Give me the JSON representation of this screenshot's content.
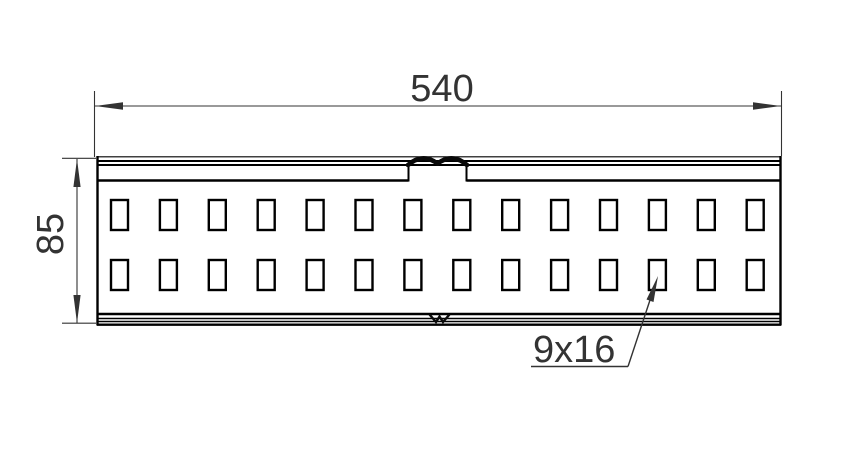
{
  "drawing": {
    "background": "#ffffff",
    "part_line_color": "#000000",
    "dimension_color": "#333333",
    "labels": {
      "length": "540",
      "height": "85",
      "slot": "9x16"
    },
    "holes": {
      "rows": 2,
      "columns": 14
    }
  }
}
